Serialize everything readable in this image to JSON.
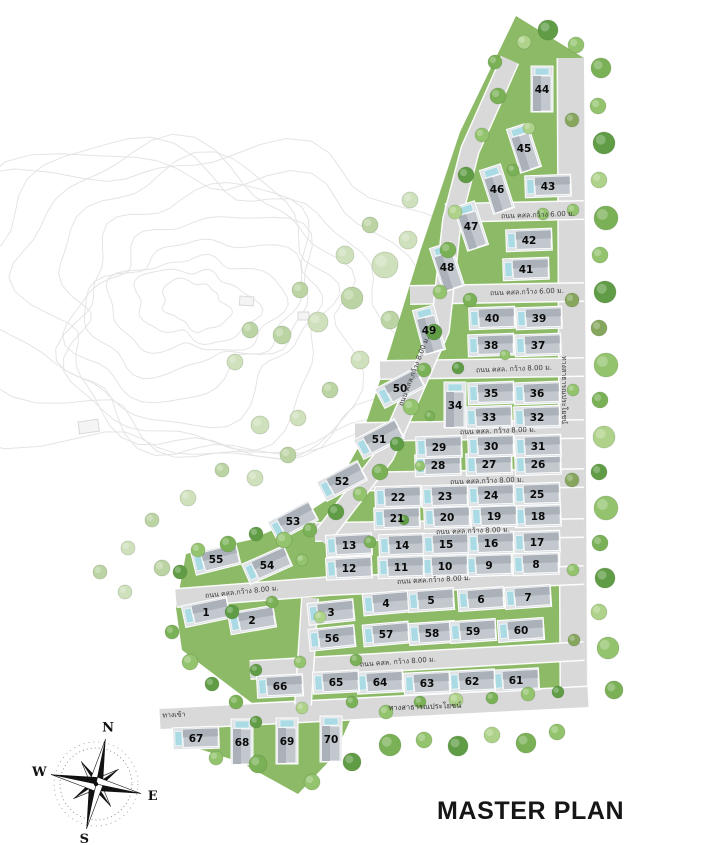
{
  "title": "MASTER PLAN",
  "compass": {
    "north": "N",
    "east": "E",
    "south": "S",
    "west": "W"
  },
  "labels": {
    "entrance": "ทางเข้า",
    "public_way_right": "ทางสาธารณประโยชน์",
    "public_way_bottom": "ทางสาธารณประโยชน์"
  },
  "road_labels": [
    {
      "text": "ถนน คสล.กว้าง 6.00 ม.",
      "x": 538,
      "y": 217,
      "rot": -2
    },
    {
      "text": "ถนน คสล.กว้าง 6.00 ม.",
      "x": 527,
      "y": 294,
      "rot": -2
    },
    {
      "text": "ถนน คสล. กว้าง 8.00 ม.",
      "x": 514,
      "y": 371,
      "rot": -2
    },
    {
      "text": "ถนน คสล. กว้าง 8.00 ม.",
      "x": 498,
      "y": 433,
      "rot": -2
    },
    {
      "text": "ถนน คสล.กว้าง 8.00 ม.",
      "x": 487,
      "y": 483,
      "rot": -2
    },
    {
      "text": "ถนน คสล.กว้าง 8.00 ม.",
      "x": 473,
      "y": 533,
      "rot": -2
    },
    {
      "text": "ถนน คสล.กว้าง 8.00 ม.",
      "x": 434,
      "y": 582,
      "rot": -3
    },
    {
      "text": "ถนน คสล.กว้าง 8.00 ม.",
      "x": 242,
      "y": 594,
      "rot": -6
    },
    {
      "text": "ถนน คสล. กว้าง 8.00 ม.",
      "x": 398,
      "y": 664,
      "rot": -4
    },
    {
      "text": "ถนน คสล.กว้าง 8.00 ม.",
      "x": 416,
      "y": 372,
      "rot": -69
    }
  ],
  "lots": [
    {
      "no": "1",
      "x": 206,
      "y": 612,
      "o": "w",
      "r": -12
    },
    {
      "no": "2",
      "x": 252,
      "y": 620,
      "o": "w",
      "r": -10
    },
    {
      "no": "3",
      "x": 331,
      "y": 612,
      "o": "w",
      "r": -6
    },
    {
      "no": "4",
      "x": 386,
      "y": 603,
      "o": "w",
      "r": -5
    },
    {
      "no": "5",
      "x": 431,
      "y": 600,
      "o": "w",
      "r": -4
    },
    {
      "no": "6",
      "x": 481,
      "y": 599,
      "o": "w",
      "r": -4
    },
    {
      "no": "7",
      "x": 528,
      "y": 597,
      "o": "w",
      "r": -4
    },
    {
      "no": "8",
      "x": 536,
      "y": 564,
      "o": "w",
      "r": -2
    },
    {
      "no": "9",
      "x": 489,
      "y": 565,
      "o": "w",
      "r": -2
    },
    {
      "no": "10",
      "x": 445,
      "y": 566,
      "o": "w",
      "r": -2
    },
    {
      "no": "11",
      "x": 401,
      "y": 567,
      "o": "w",
      "r": -2
    },
    {
      "no": "12",
      "x": 349,
      "y": 568,
      "o": "w",
      "r": -3
    },
    {
      "no": "13",
      "x": 349,
      "y": 545,
      "o": "w",
      "r": -3
    },
    {
      "no": "14",
      "x": 402,
      "y": 545,
      "o": "w",
      "r": -2
    },
    {
      "no": "15",
      "x": 446,
      "y": 544,
      "o": "w",
      "r": -2
    },
    {
      "no": "16",
      "x": 491,
      "y": 543,
      "o": "w",
      "r": -2
    },
    {
      "no": "17",
      "x": 537,
      "y": 542,
      "o": "w",
      "r": -2
    },
    {
      "no": "18",
      "x": 538,
      "y": 516,
      "o": "w",
      "r": -2
    },
    {
      "no": "19",
      "x": 494,
      "y": 516,
      "o": "w",
      "r": -2
    },
    {
      "no": "20",
      "x": 447,
      "y": 517,
      "o": "w",
      "r": -2
    },
    {
      "no": "21",
      "x": 397,
      "y": 518,
      "o": "w",
      "r": -2
    },
    {
      "no": "22",
      "x": 398,
      "y": 497,
      "o": "w",
      "r": -2
    },
    {
      "no": "23",
      "x": 445,
      "y": 496,
      "o": "w",
      "r": -2
    },
    {
      "no": "24",
      "x": 491,
      "y": 495,
      "o": "w",
      "r": -2
    },
    {
      "no": "25",
      "x": 537,
      "y": 494,
      "o": "w",
      "r": -2
    },
    {
      "no": "26",
      "x": 538,
      "y": 464,
      "o": "w",
      "r": -2
    },
    {
      "no": "27",
      "x": 489,
      "y": 464,
      "o": "w",
      "r": -2
    },
    {
      "no": "28",
      "x": 438,
      "y": 465,
      "o": "w",
      "r": -2
    },
    {
      "no": "29",
      "x": 439,
      "y": 447,
      "o": "w",
      "r": -2
    },
    {
      "no": "30",
      "x": 491,
      "y": 446,
      "o": "w",
      "r": -2
    },
    {
      "no": "31",
      "x": 538,
      "y": 446,
      "o": "w",
      "r": -2
    },
    {
      "no": "32",
      "x": 537,
      "y": 417,
      "o": "w",
      "r": -2
    },
    {
      "no": "33",
      "x": 489,
      "y": 417,
      "o": "w",
      "r": -2
    },
    {
      "no": "34",
      "x": 455,
      "y": 405,
      "o": "v",
      "r": 0
    },
    {
      "no": "35",
      "x": 491,
      "y": 393,
      "o": "w",
      "r": -2
    },
    {
      "no": "36",
      "x": 537,
      "y": 393,
      "o": "w",
      "r": -2
    },
    {
      "no": "37",
      "x": 538,
      "y": 345,
      "o": "w",
      "r": -2
    },
    {
      "no": "38",
      "x": 491,
      "y": 345,
      "o": "w",
      "r": -2
    },
    {
      "no": "39",
      "x": 539,
      "y": 318,
      "o": "w",
      "r": -2
    },
    {
      "no": "40",
      "x": 492,
      "y": 318,
      "o": "w",
      "r": -2
    },
    {
      "no": "41",
      "x": 526,
      "y": 269,
      "o": "w",
      "r": -2
    },
    {
      "no": "42",
      "x": 529,
      "y": 240,
      "o": "w",
      "r": -2
    },
    {
      "no": "43",
      "x": 548,
      "y": 186,
      "o": "w",
      "r": -2
    },
    {
      "no": "44",
      "x": 542,
      "y": 89,
      "o": "v",
      "r": 0
    },
    {
      "no": "45",
      "x": 524,
      "y": 148,
      "o": "v",
      "r": -18
    },
    {
      "no": "46",
      "x": 497,
      "y": 189,
      "o": "v",
      "r": -18
    },
    {
      "no": "47",
      "x": 471,
      "y": 226,
      "o": "v",
      "r": -18
    },
    {
      "no": "48",
      "x": 447,
      "y": 267,
      "o": "v",
      "r": -18
    },
    {
      "no": "49",
      "x": 429,
      "y": 330,
      "o": "v",
      "r": -15
    },
    {
      "no": "50",
      "x": 400,
      "y": 388,
      "o": "w",
      "r": -28
    },
    {
      "no": "51",
      "x": 379,
      "y": 439,
      "o": "w",
      "r": -28
    },
    {
      "no": "52",
      "x": 342,
      "y": 481,
      "o": "w",
      "r": -28
    },
    {
      "no": "53",
      "x": 293,
      "y": 521,
      "o": "w",
      "r": -28
    },
    {
      "no": "54",
      "x": 267,
      "y": 565,
      "o": "w",
      "r": -24
    },
    {
      "no": "55",
      "x": 216,
      "y": 559,
      "o": "w",
      "r": -14
    },
    {
      "no": "56",
      "x": 332,
      "y": 638,
      "o": "w",
      "r": -6
    },
    {
      "no": "57",
      "x": 386,
      "y": 634,
      "o": "w",
      "r": -5
    },
    {
      "no": "58",
      "x": 432,
      "y": 633,
      "o": "w",
      "r": -4
    },
    {
      "no": "59",
      "x": 473,
      "y": 631,
      "o": "w",
      "r": -4
    },
    {
      "no": "60",
      "x": 521,
      "y": 630,
      "o": "w",
      "r": -4
    },
    {
      "no": "61",
      "x": 516,
      "y": 680,
      "o": "w",
      "r": -3
    },
    {
      "no": "62",
      "x": 472,
      "y": 681,
      "o": "w",
      "r": -3
    },
    {
      "no": "63",
      "x": 427,
      "y": 683,
      "o": "w",
      "r": -3
    },
    {
      "no": "64",
      "x": 380,
      "y": 682,
      "o": "w",
      "r": -3
    },
    {
      "no": "65",
      "x": 336,
      "y": 682,
      "o": "w",
      "r": -3
    },
    {
      "no": "66",
      "x": 280,
      "y": 686,
      "o": "w",
      "r": -3
    },
    {
      "no": "67",
      "x": 196,
      "y": 738,
      "o": "w",
      "r": -2
    },
    {
      "no": "68",
      "x": 242,
      "y": 742,
      "o": "v",
      "r": 0
    },
    {
      "no": "69",
      "x": 287,
      "y": 741,
      "o": "v",
      "r": 0
    },
    {
      "no": "70",
      "x": 331,
      "y": 739,
      "o": "v",
      "r": 0
    }
  ],
  "colors": {
    "grass": "#8cba66",
    "road": "#d9d9d9",
    "road_casing": "#ffffff",
    "roof": "#c2c8ce",
    "roof_dark": "#aab1b8",
    "pad": "#e0e3e6",
    "pool": "#aadbe4",
    "number_text": "#0a0a0a",
    "label_text": "#3a3a3a",
    "contour": "#e4e4e4"
  }
}
